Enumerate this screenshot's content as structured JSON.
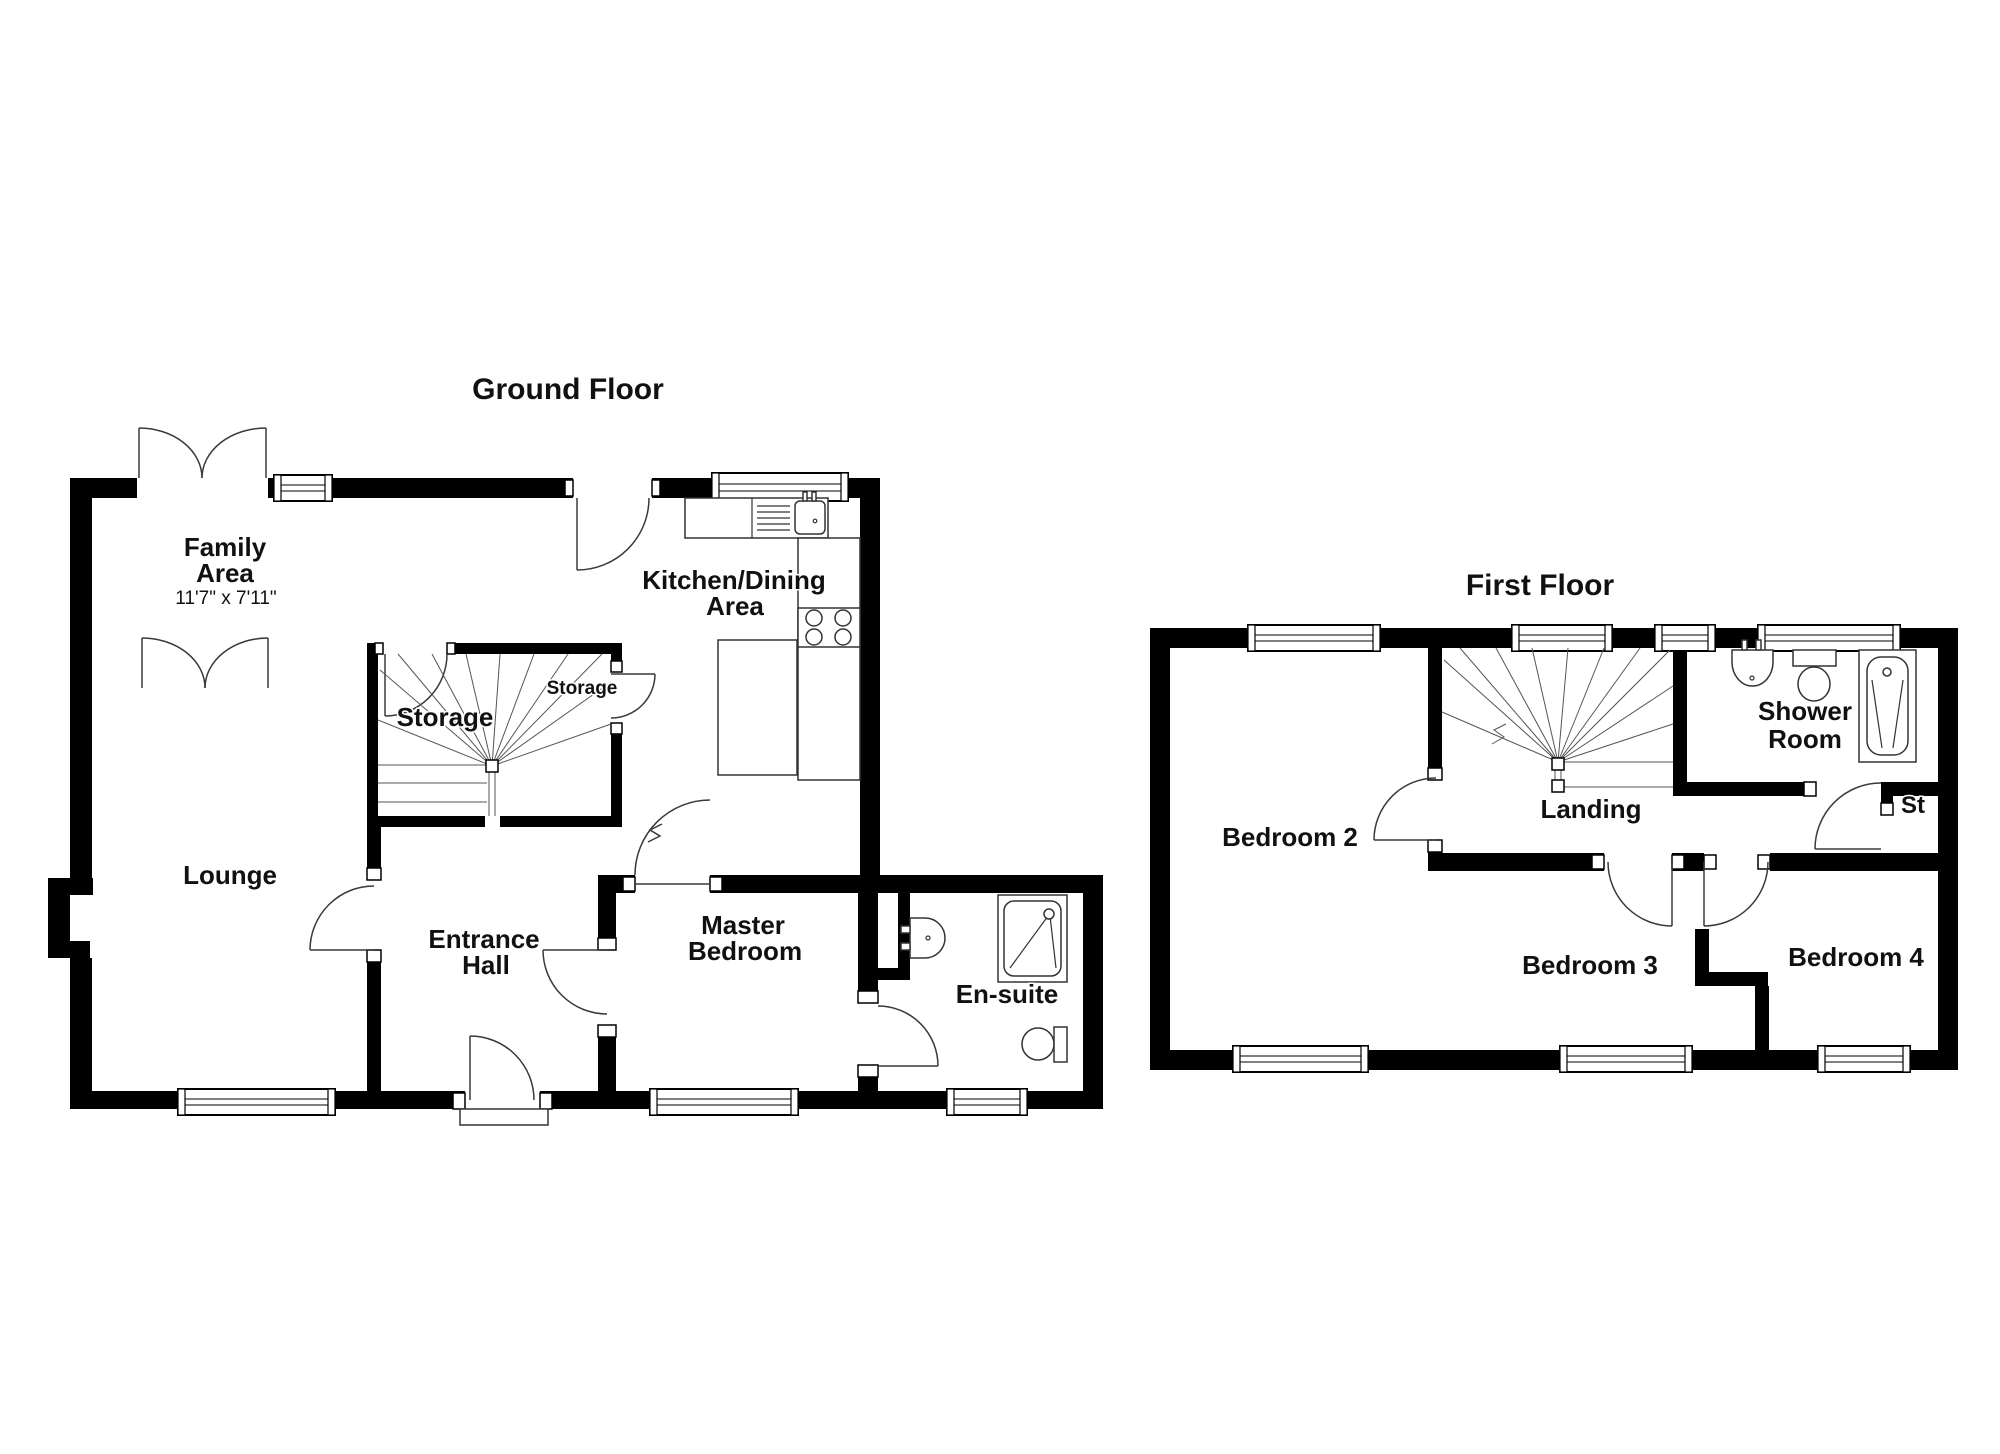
{
  "ground_floor": {
    "title": "Ground Floor",
    "family_area": {
      "line1": "Family",
      "line2": "Area",
      "dims": "11'7\" x 7'11\""
    },
    "kitchen_dining": {
      "line1": "Kitchen/Dining",
      "line2": "Area"
    },
    "storage_main": "Storage",
    "storage_small": "Storage",
    "lounge": "Lounge",
    "entrance_hall": {
      "line1": "Entrance",
      "line2": "Hall"
    },
    "master_bedroom": {
      "line1": "Master",
      "line2": "Bedroom"
    },
    "ensuite": "En-suite"
  },
  "first_floor": {
    "title": "First Floor",
    "bedroom2": "Bedroom 2",
    "landing": "Landing",
    "shower_room": {
      "line1": "Shower",
      "line2": "Room"
    },
    "storage_cupboard": "St",
    "bedroom3": "Bedroom 3",
    "bedroom4": "Bedroom 4"
  },
  "colors": {
    "wall": "#000000",
    "background": "#ffffff",
    "text": "#111111"
  }
}
